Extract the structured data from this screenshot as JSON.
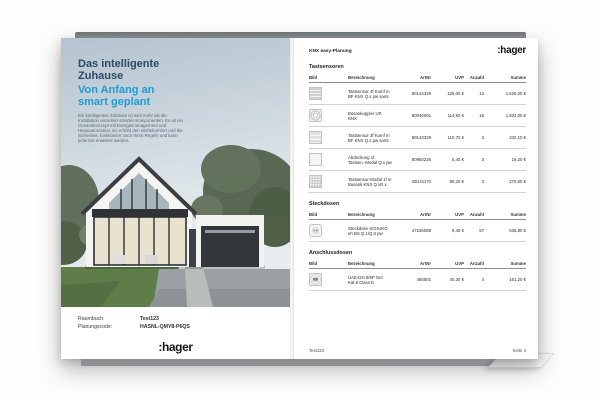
{
  "colors": {
    "title_navy": "#2b4a63",
    "subtitle_cyan": "#1e9cd7",
    "logo_black": "#141414",
    "sky_top": "#b4c3d0",
    "garage_door_dark": "#33373b",
    "lawn_green": "#5f7d49"
  },
  "book": {
    "left_page": {
      "title": "Das intelligente\nZuhause",
      "subtitle": "Von Anfang an\nsmart geplant",
      "body_text": "Ein intelligentes Zuhause ist weit mehr als die Installation einzelner smarter Komponenten. Es ist ein Gesamtkonzept mit Energiemanagement und Hausautomation. Es erhöht den Wohnkomfort und die Sicherheit, funktioniert nach Ihren Regeln und kann jederzeit erweitert werden.",
      "raumbuch_label": "Raumbuch:",
      "raumbuch_value": "Test123",
      "planungscode_label": "Planungscode:",
      "planungscode_value": "HASNL-QMY8-P6QS",
      "logo": ":hager",
      "cover_image": "modern-gabled-house-with-glass-front-garage-trees-and-lawn"
    },
    "right_page": {
      "header": "KNX easy-Planung",
      "logo": ":hager",
      "columns": [
        "Bild",
        "Bezeichnung",
        "ArtNr",
        "UVP",
        "Anzahl",
        "Summe"
      ],
      "sections": [
        {
          "title": "Tastsensoren",
          "rows": [
            {
              "icon": "keypad-4",
              "bezeichnung": "Tastsensor 4f Komf m BF KNX Q.s pw samt",
              "artnr": "80144329",
              "uvp": "125,00 €",
              "anzahl": "13",
              "summe": "1.625,00 €"
            },
            {
              "icon": "buscoupler",
              "bezeichnung": "Busankoppler UP, KNX",
              "artnr": "80040001",
              "uvp": "114,50 €",
              "anzahl": "16",
              "summe": "1.832,00 €"
            },
            {
              "icon": "keypad-3",
              "bezeichnung": "Tastsensor 3f Komf m BF KNX Q.s pw samt",
              "artnr": "80143329",
              "uvp": "110,70 €",
              "anzahl": "3",
              "summe": "332,10 €"
            },
            {
              "icon": "cover-plate",
              "bezeichnung": "Abdeckung 1f. Tastsen.-Modul Q.x pw",
              "artnr": "80960226",
              "uvp": "5,40 €",
              "anzahl": "3",
              "summe": "16,20 €"
            },
            {
              "icon": "module-grid",
              "bezeichnung": "Tastsensor-Modul 1f m Busank KNX Q.xR.x",
              "artnr": "80141170",
              "uvp": "90,20 €",
              "anzahl": "3",
              "summe": "270,60 €"
            }
          ]
        },
        {
          "title": "Steckdosen",
          "rows": [
            {
              "icon": "socket",
              "bezeichnung": "Steckdose SCHUKO eh BS Q.1/Q.3 pw",
              "artnr": "47236089",
              "uvp": "9,40 €",
              "anzahl": "57",
              "summe": "535,80 €"
            }
          ]
        },
        {
          "title": "Anschlussdosen",
          "rows": [
            {
              "icon": "uae",
              "bezeichnung": "UAE-Dst 8/8P Gel Kat.6 Class E",
              "artnr": "450501",
              "uvp": "40,30 €",
              "anzahl": "4",
              "summe": "161,20 €"
            }
          ]
        }
      ],
      "footer_left": "Test123",
      "footer_right": "Seite 3"
    }
  }
}
